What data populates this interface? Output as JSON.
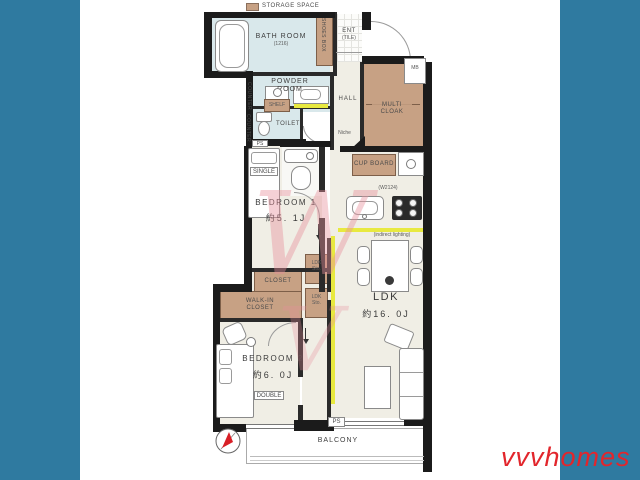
{
  "page": {
    "frame_color": "#2f7aa0",
    "canvas_color": "#ffffff",
    "type": "apartment floor plan"
  },
  "branding": {
    "logo": "vvvhomes",
    "logo_color": "#e2262c"
  },
  "legend": {
    "storage_space": "STORAGE SPACE",
    "swatch_color": "#c7a184"
  },
  "colors": {
    "wall": "#1b1b1b",
    "floor_cream": "#f0eee5",
    "wet_area_blue": "#d9e8eb",
    "storage_brown": "#c7a184",
    "accent_yellow": "#e8e93f",
    "watermark_pink": "#e78f9c",
    "background_blue": "#2f7aa0",
    "logo_red": "#e2262c"
  },
  "rooms": {
    "bath_room": {
      "name": "BATH ROOM",
      "size": "(1216)"
    },
    "shoes_box": {
      "name": "SHOES BOX"
    },
    "entrance": {
      "name": "ENT",
      "floor": "(TILE)"
    },
    "powder_room": {
      "name": "POWDER\nROOM"
    },
    "toilet": {
      "name": "TOILET"
    },
    "hall": {
      "name": "HALL"
    },
    "multi_cloak": {
      "name": "MULTI\nCLOAK"
    },
    "cup_board": {
      "name": "CUP BOARD"
    },
    "bedroom1": {
      "name": "BEDROOM 1",
      "size": "約5. 1J"
    },
    "bedroom2": {
      "name": "BEDROOM 2",
      "size": "約6. 0J"
    },
    "ldk": {
      "name": "LDK",
      "size": "約16. 0J"
    },
    "ldk_storage1": {
      "name": "LDK\nSto."
    },
    "ldk_storage2": {
      "name": "LDK\nSto."
    },
    "closet": {
      "name": "CLOSET"
    },
    "walk_in_closet": {
      "name": "WALK-IN\nCLOSET"
    },
    "balcony": {
      "name": "BALCONY"
    }
  },
  "labels": {
    "mb": "MB",
    "ps_top": "PS",
    "ps_bottom": "PS",
    "niche": "Niche",
    "shelf": "SHELF",
    "counter_upper": "COUNTER",
    "counter_lower": "COUNTER",
    "single_bed": "SINGLE",
    "double_bed": "DOUBLE",
    "kitchen_width": "(W2124)",
    "indirect_lighting": "(indirect lighting)"
  },
  "watermark": {
    "upper": "W",
    "lower": "V"
  }
}
